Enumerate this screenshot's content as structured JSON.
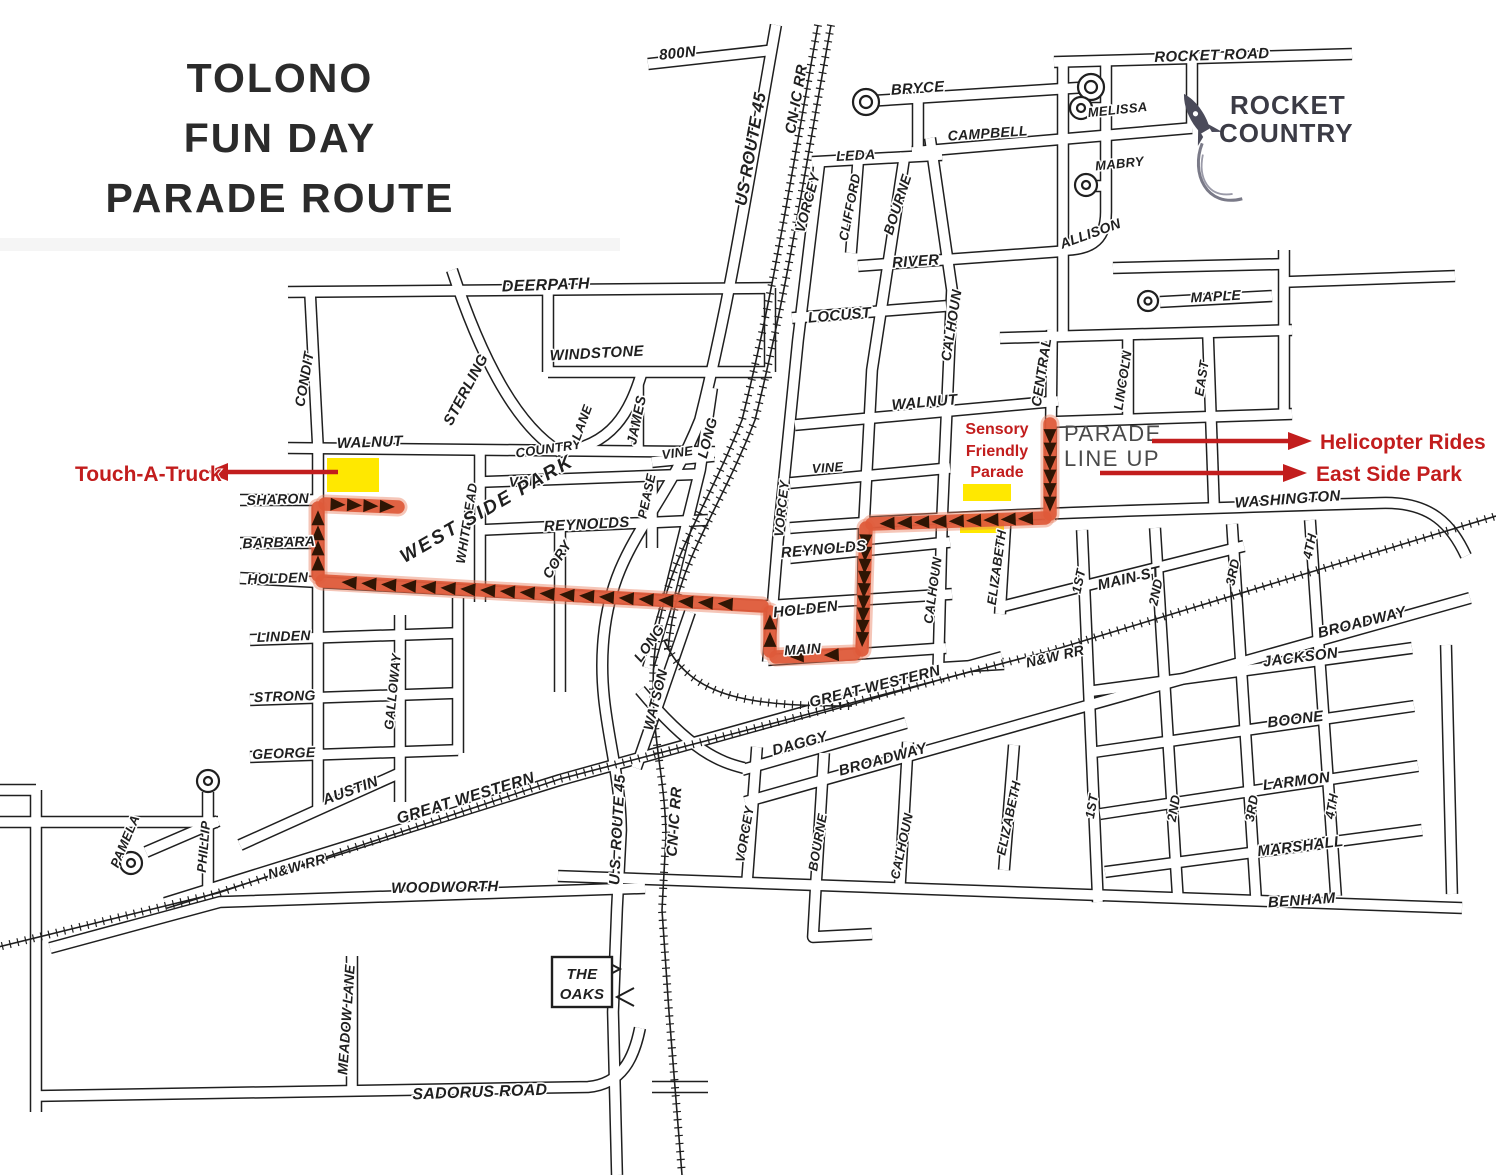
{
  "title": {
    "lines": [
      "TOLONO",
      "FUN DAY",
      "PARADE ROUTE"
    ]
  },
  "rocket_logo": {
    "lines": [
      "ROCKET",
      "COUNTRY"
    ]
  },
  "parade_line_up": {
    "lines": [
      "PARADE",
      "LINE UP"
    ]
  },
  "the_oaks": {
    "lines": [
      "THE",
      "OAKS"
    ]
  },
  "annotations": {
    "touch_a_truck": {
      "label": "Touch-A-Truck"
    },
    "sensory_friendly_parade": {
      "lines": [
        "Sensory",
        "Friendly",
        "Parade"
      ]
    },
    "helicopter_rides": {
      "label": "Helicopter Rides"
    },
    "east_side_park": {
      "label": "East Side Park"
    }
  },
  "colors": {
    "map_ink": "#1f1f1f",
    "route": "#df5a3a",
    "route_halo": "#e98263",
    "route_arrow": "#2f1504",
    "highlight_yellow": "#ffe800",
    "annotation_red": "#c21d1d",
    "parade_text": "#4a4a4a",
    "logo_text": "#3b3b45"
  },
  "map": {
    "street_labels": [
      {
        "t": "800N",
        "x": 678,
        "y": 58,
        "r": -6,
        "s": 15
      },
      {
        "t": "US ROUTE 45",
        "x": 756,
        "y": 150,
        "r": -80,
        "s": 17
      },
      {
        "t": "CN-IC RR",
        "x": 801,
        "y": 100,
        "r": -80,
        "s": 15
      },
      {
        "t": "BRYCE",
        "x": 918,
        "y": 93,
        "r": -4,
        "s": 15
      },
      {
        "t": "CAMPBELL",
        "x": 988,
        "y": 138,
        "r": -4,
        "s": 14
      },
      {
        "t": "LEDA",
        "x": 856,
        "y": 160,
        "r": -3,
        "s": 14
      },
      {
        "t": "VORCEY",
        "x": 812,
        "y": 204,
        "r": -75,
        "s": 14
      },
      {
        "t": "CLIFFORD",
        "x": 854,
        "y": 208,
        "r": -79,
        "s": 13
      },
      {
        "t": "BOURNE",
        "x": 902,
        "y": 206,
        "r": -72,
        "s": 14
      },
      {
        "t": "RIVER",
        "x": 916,
        "y": 266,
        "r": -4,
        "s": 15
      },
      {
        "t": "LOCUST",
        "x": 840,
        "y": 320,
        "r": -5,
        "s": 15
      },
      {
        "t": "CALHOUN",
        "x": 956,
        "y": 326,
        "r": -81,
        "s": 14
      },
      {
        "t": "MELISSA",
        "x": 1118,
        "y": 114,
        "r": -6,
        "s": 13
      },
      {
        "t": "MABRY",
        "x": 1120,
        "y": 168,
        "r": -6,
        "s": 13
      },
      {
        "t": "ALLISON",
        "x": 1092,
        "y": 238,
        "r": -20,
        "s": 14
      },
      {
        "t": "ROCKET ROAD",
        "x": 1212,
        "y": 60,
        "r": -2,
        "s": 15
      },
      {
        "t": "MAPLE",
        "x": 1216,
        "y": 301,
        "r": -3,
        "s": 14
      },
      {
        "t": "DEERPATH",
        "x": 546,
        "y": 290,
        "r": -2,
        "s": 16
      },
      {
        "t": "WINDSTONE",
        "x": 597,
        "y": 358,
        "r": -3,
        "s": 15
      },
      {
        "t": "STERLING",
        "x": 470,
        "y": 392,
        "r": -62,
        "s": 15
      },
      {
        "t": "CONDIT",
        "x": 309,
        "y": 380,
        "r": -80,
        "s": 14
      },
      {
        "t": "WALNUT",
        "x": 370,
        "y": 447,
        "r": -2,
        "s": 15
      },
      {
        "t": "COUNTRY",
        "x": 549,
        "y": 453,
        "r": -8,
        "s": 13
      },
      {
        "t": "LANE",
        "x": 586,
        "y": 424,
        "r": -70,
        "s": 13
      },
      {
        "t": "JAMES",
        "x": 641,
        "y": 421,
        "r": -78,
        "s": 14
      },
      {
        "t": "VINE",
        "x": 678,
        "y": 457,
        "r": -8,
        "s": 13
      },
      {
        "t": "VINE",
        "x": 526,
        "y": 486,
        "r": -3,
        "s": 14
      },
      {
        "t": "PEASE",
        "x": 651,
        "y": 497,
        "r": -78,
        "s": 13
      },
      {
        "t": "LONG",
        "x": 712,
        "y": 439,
        "r": -75,
        "s": 14
      },
      {
        "t": "WHITEHEAD",
        "x": 471,
        "y": 524,
        "r": -81,
        "s": 13
      },
      {
        "t": "REYNOLDS",
        "x": 587,
        "y": 529,
        "r": -3,
        "s": 15
      },
      {
        "t": "CORY",
        "x": 561,
        "y": 562,
        "r": -58,
        "s": 14
      },
      {
        "t": "SHARON",
        "x": 278,
        "y": 504,
        "r": -2,
        "s": 14
      },
      {
        "t": "BARBARA",
        "x": 279,
        "y": 547,
        "r": -2,
        "s": 14
      },
      {
        "t": "HOLDEN",
        "x": 278,
        "y": 583,
        "r": -2,
        "s": 14
      },
      {
        "t": "WEST SIDE PARK",
        "x": 490,
        "y": 514,
        "r": -30,
        "s": 19
      },
      {
        "t": "LINDEN",
        "x": 284,
        "y": 641,
        "r": -2,
        "s": 14
      },
      {
        "t": "STRONG",
        "x": 285,
        "y": 701,
        "r": -2,
        "s": 14
      },
      {
        "t": "GEORGE",
        "x": 284,
        "y": 758,
        "r": -2,
        "s": 14
      },
      {
        "t": "GALLOWAY",
        "x": 397,
        "y": 692,
        "r": -84,
        "s": 13
      },
      {
        "t": "AUSTIN",
        "x": 352,
        "y": 795,
        "r": -20,
        "s": 15
      },
      {
        "t": "GREAT WESTERN",
        "x": 467,
        "y": 803,
        "r": -17,
        "s": 16
      },
      {
        "t": "PHILLIP",
        "x": 208,
        "y": 847,
        "r": -85,
        "s": 13
      },
      {
        "t": "PAMELA",
        "x": 129,
        "y": 843,
        "r": -67,
        "s": 13
      },
      {
        "t": "N&W RR",
        "x": 298,
        "y": 871,
        "r": -16,
        "s": 14
      },
      {
        "t": "WOODWORTH",
        "x": 445,
        "y": 892,
        "r": -1,
        "s": 15
      },
      {
        "t": "MEADOW LANE",
        "x": 351,
        "y": 1020,
        "r": -86,
        "s": 14
      },
      {
        "t": "SADORUS ROAD",
        "x": 480,
        "y": 1097,
        "r": -2,
        "s": 16
      },
      {
        "t": "U.S. ROUTE 45",
        "x": 622,
        "y": 830,
        "r": -87,
        "s": 15
      },
      {
        "t": "CN-IC RR",
        "x": 679,
        "y": 822,
        "r": -86,
        "s": 15
      },
      {
        "t": "LONG",
        "x": 653,
        "y": 646,
        "r": -55,
        "s": 14
      },
      {
        "t": "WATSON",
        "x": 660,
        "y": 701,
        "r": -76,
        "s": 14
      },
      {
        "t": "VORCEY",
        "x": 786,
        "y": 509,
        "r": -84,
        "s": 13
      },
      {
        "t": "VINE",
        "x": 828,
        "y": 472,
        "r": -4,
        "s": 13
      },
      {
        "t": "REYNOLDS",
        "x": 824,
        "y": 554,
        "r": -5,
        "s": 15
      },
      {
        "t": "HOLDEN",
        "x": 806,
        "y": 614,
        "r": -6,
        "s": 15
      },
      {
        "t": "MAIN",
        "x": 803,
        "y": 654,
        "r": -4,
        "s": 14
      },
      {
        "t": "WALNUT",
        "x": 925,
        "y": 407,
        "r": -5,
        "s": 15
      },
      {
        "t": "CENTRAL",
        "x": 1046,
        "y": 373,
        "r": -81,
        "s": 14
      },
      {
        "t": "LINCOLN",
        "x": 1127,
        "y": 381,
        "r": -81,
        "s": 13
      },
      {
        "t": "EAST",
        "x": 1206,
        "y": 379,
        "r": -81,
        "s": 13
      },
      {
        "t": "CALHOUN",
        "x": 937,
        "y": 591,
        "r": -82,
        "s": 13
      },
      {
        "t": "ELIZABETH",
        "x": 1001,
        "y": 568,
        "r": -82,
        "s": 13
      },
      {
        "t": "WASHINGTON",
        "x": 1288,
        "y": 504,
        "r": -4,
        "s": 15
      },
      {
        "t": "MAIN ST",
        "x": 1130,
        "y": 583,
        "r": -13,
        "s": 15
      },
      {
        "t": "1ST",
        "x": 1083,
        "y": 582,
        "r": -78,
        "s": 13
      },
      {
        "t": "2ND",
        "x": 1160,
        "y": 593,
        "r": -78,
        "s": 13
      },
      {
        "t": "3RD",
        "x": 1237,
        "y": 573,
        "r": -78,
        "s": 13
      },
      {
        "t": "4TH",
        "x": 1314,
        "y": 547,
        "r": -78,
        "s": 13
      },
      {
        "t": "N&W RR",
        "x": 1056,
        "y": 661,
        "r": -13,
        "s": 14
      },
      {
        "t": "GREAT WESTERN",
        "x": 876,
        "y": 691,
        "r": -14,
        "s": 15
      },
      {
        "t": "DAGGY",
        "x": 801,
        "y": 748,
        "r": -15,
        "s": 15
      },
      {
        "t": "BROADWAY",
        "x": 884,
        "y": 764,
        "r": -15,
        "s": 15
      },
      {
        "t": "VORCEY",
        "x": 749,
        "y": 835,
        "r": -80,
        "s": 13
      },
      {
        "t": "BOURNE",
        "x": 822,
        "y": 843,
        "r": -80,
        "s": 13
      },
      {
        "t": "CALHOUN",
        "x": 906,
        "y": 847,
        "r": -78,
        "s": 13
      },
      {
        "t": "ELIZABETH",
        "x": 1013,
        "y": 819,
        "r": -78,
        "s": 13
      },
      {
        "t": "1ST",
        "x": 1096,
        "y": 807,
        "r": -80,
        "s": 13
      },
      {
        "t": "2ND",
        "x": 1178,
        "y": 809,
        "r": -80,
        "s": 13
      },
      {
        "t": "3RD",
        "x": 1256,
        "y": 809,
        "r": -80,
        "s": 13
      },
      {
        "t": "4TH",
        "x": 1336,
        "y": 807,
        "r": -80,
        "s": 13
      },
      {
        "t": "BROADWAY",
        "x": 1363,
        "y": 627,
        "r": -14,
        "s": 15
      },
      {
        "t": "JACKSON",
        "x": 1301,
        "y": 662,
        "r": -7,
        "s": 15
      },
      {
        "t": "BOONE",
        "x": 1296,
        "y": 724,
        "r": -7,
        "s": 15
      },
      {
        "t": "LARMON",
        "x": 1297,
        "y": 786,
        "r": -7,
        "s": 15
      },
      {
        "t": "MARSHALL",
        "x": 1301,
        "y": 851,
        "r": -7,
        "s": 15
      },
      {
        "t": "BENHAM",
        "x": 1302,
        "y": 905,
        "r": -4,
        "s": 15
      }
    ],
    "route": {
      "segments": [
        {
          "from": [
            1050,
            424
          ],
          "to": [
            1050,
            514
          ],
          "arrows": 6
        },
        {
          "from": [
            1045,
            518
          ],
          "to": [
            872,
            524
          ],
          "arrows": 9
        },
        {
          "from": [
            866,
            528
          ],
          "to": [
            862,
            650
          ],
          "arrows": 9
        },
        {
          "from": [
            854,
            654
          ],
          "to": [
            776,
            657
          ],
          "arrows": 2
        },
        {
          "from": [
            770,
            651
          ],
          "to": [
            770,
            612
          ],
          "arrows": 2
        },
        {
          "from": [
            762,
            606
          ],
          "to": [
            322,
            581
          ],
          "arrows": 20
        },
        {
          "from": [
            318,
            575
          ],
          "to": [
            318,
            508
          ],
          "arrows": 4
        },
        {
          "from": [
            325,
            504
          ],
          "to": [
            398,
            507
          ],
          "arrows": 4
        }
      ]
    },
    "highlight_areas": [
      {
        "name": "touch-a-truck-area",
        "x": 327,
        "y": 458,
        "w": 52,
        "h": 34
      },
      {
        "name": "sensory-parade-area-north",
        "x": 963,
        "y": 484,
        "w": 48,
        "h": 17
      },
      {
        "name": "sensory-parade-area-south",
        "x": 960,
        "y": 514,
        "w": 44,
        "h": 19
      }
    ]
  }
}
